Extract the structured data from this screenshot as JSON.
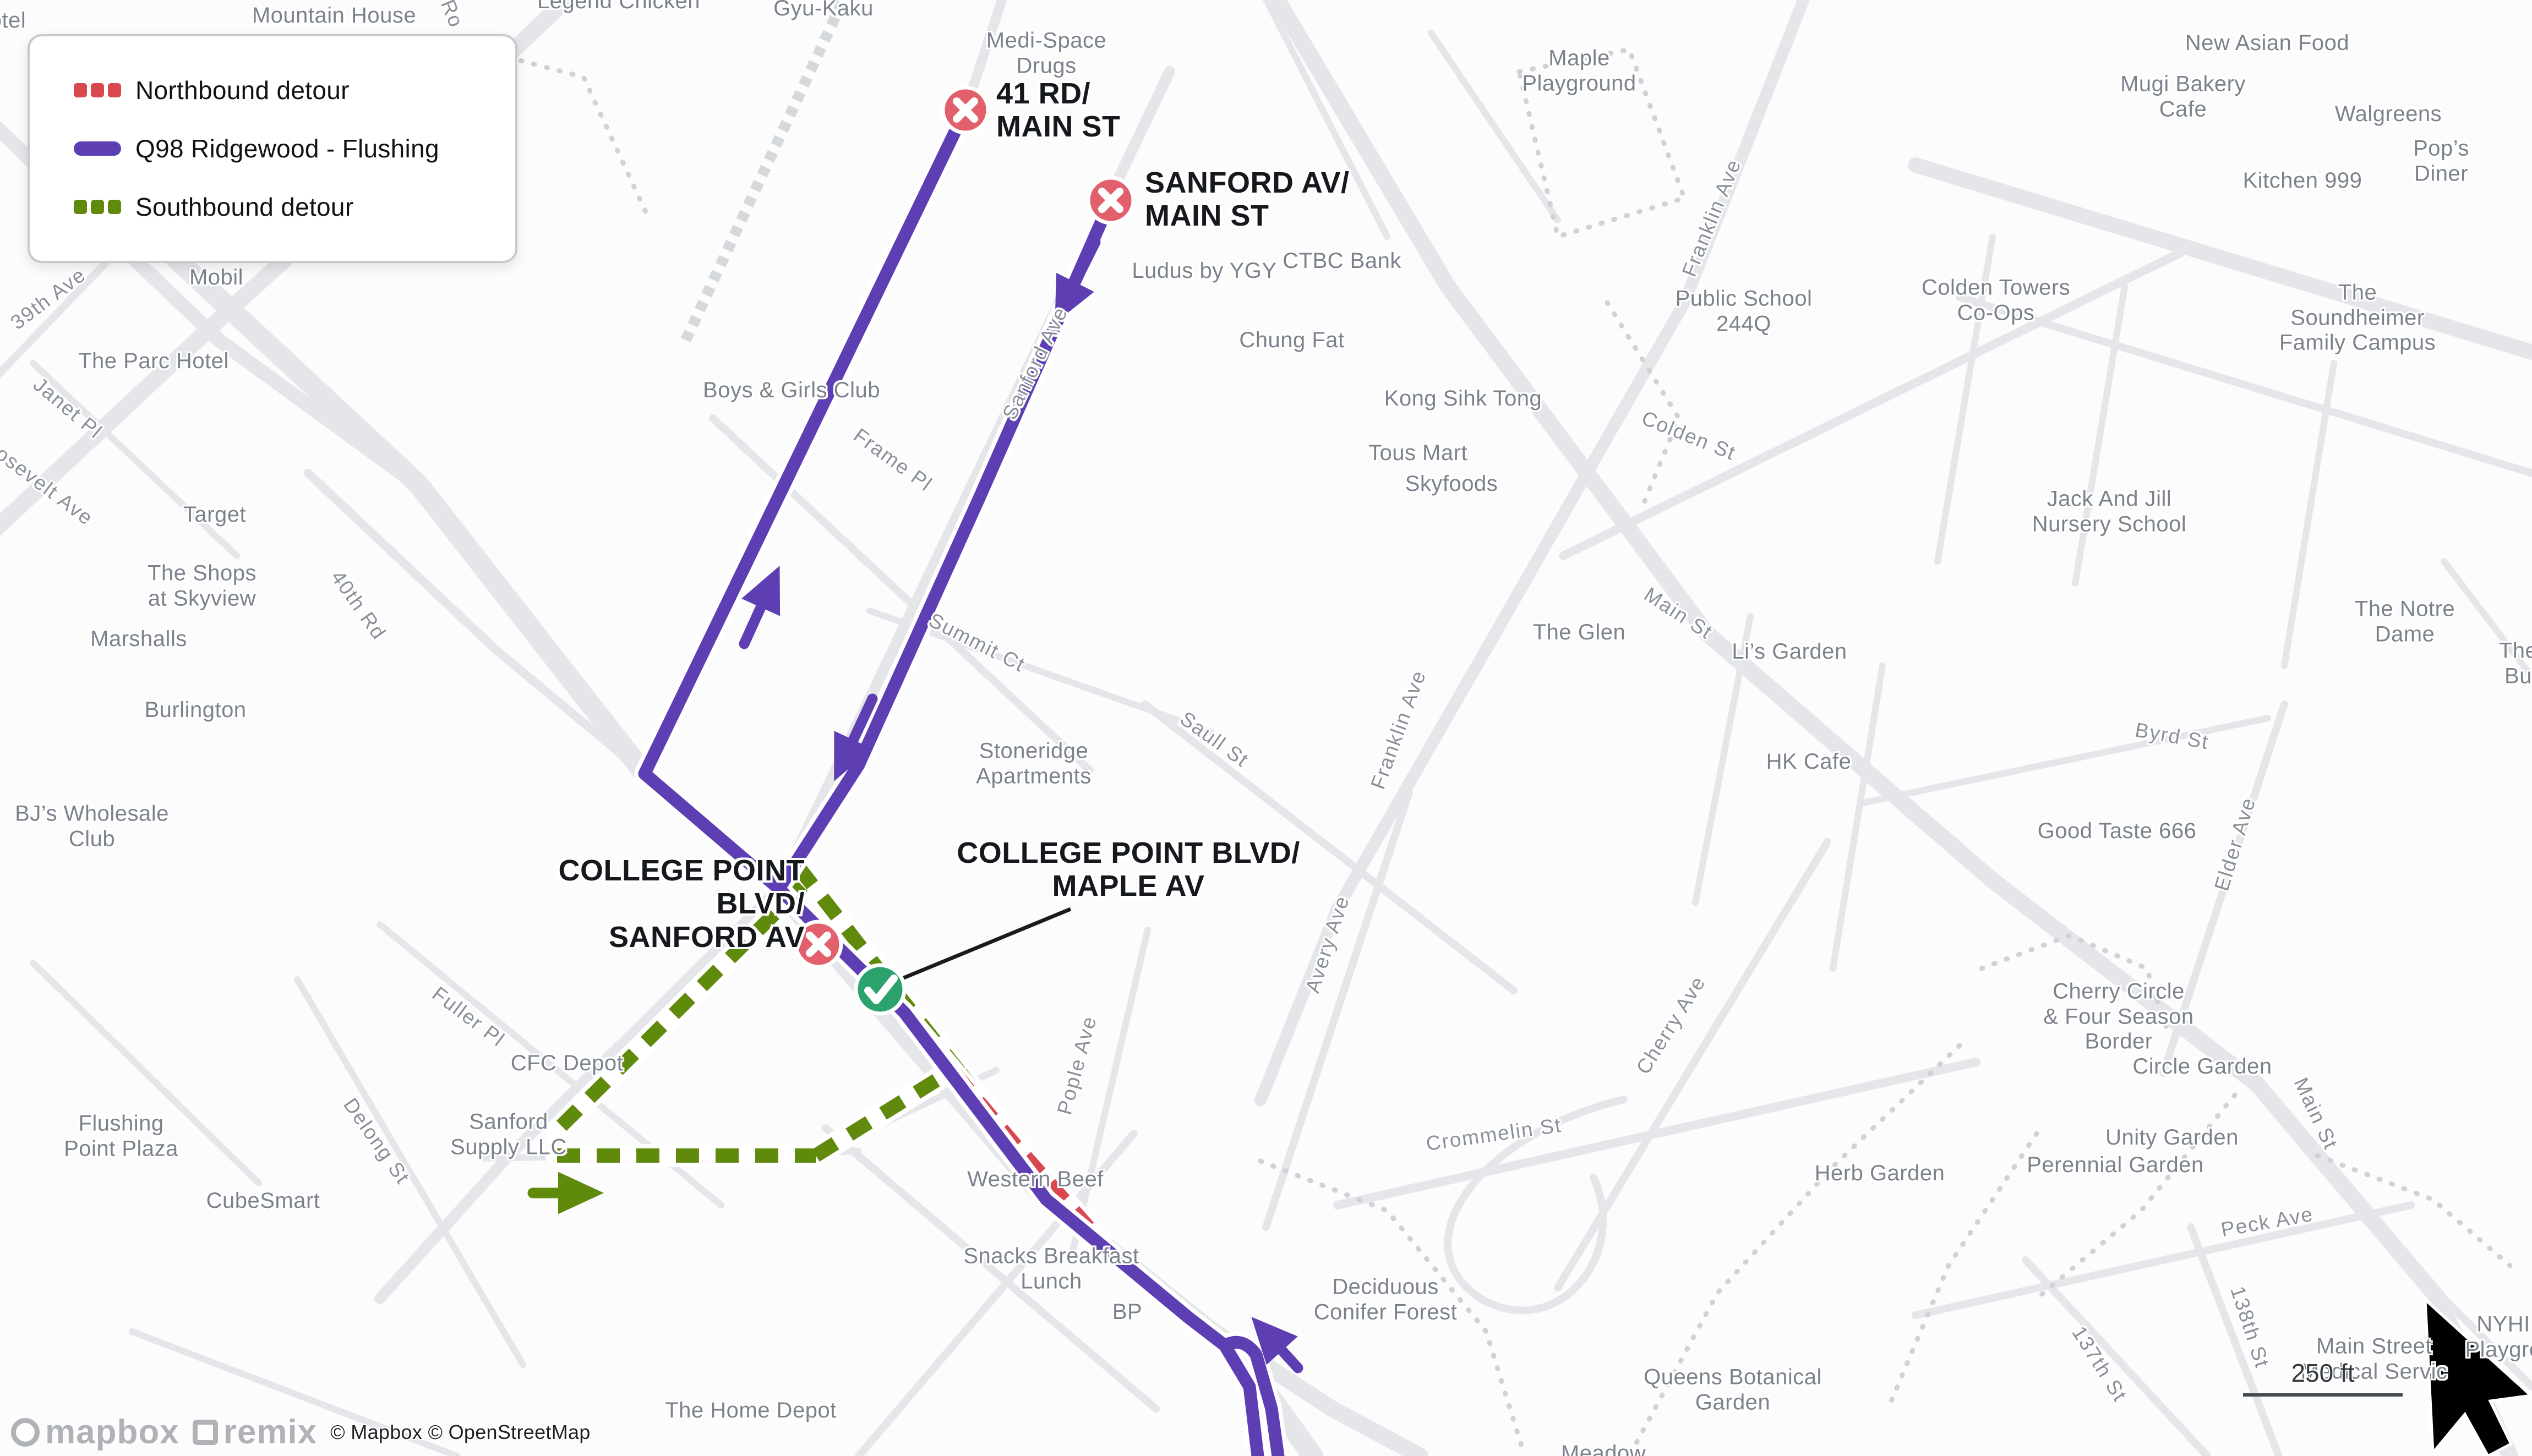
{
  "legend": {
    "items": [
      {
        "label": "Northbound detour",
        "color": "#D9474F",
        "style": "dashed"
      },
      {
        "label": "Q98 Ridgewood - Flushing",
        "color": "#5D3EB3",
        "style": "solid"
      },
      {
        "label": "Southbound detour",
        "color": "#5F8A0C",
        "style": "dashed"
      }
    ]
  },
  "stops": {
    "rd41": "41 RD/\nMAIN ST",
    "sanford": "SANFORD AV/\nMAIN ST",
    "cp_sanford": "COLLEGE POINT BLVD/\nSANFORD AV",
    "cp_maple": "COLLEGE POINT BLVD/\nMAPLE AV"
  },
  "labels": {
    "otel": "otel",
    "mountain_house": "Mountain House",
    "legend_chicken": "Legend Chicken",
    "gyu_kaku": "Gyu-Kaku",
    "medi_space": "Medi-Space\nDrugs",
    "new_asian": "New Asian Food",
    "mugi": "Mugi Bakery\nCafe",
    "walgreens": "Walgreens",
    "pops": "Pop’s Diner",
    "kitchen999": "Kitchen 999",
    "maple_pg": "Maple\nPlayground",
    "ludus": "Ludus by YGY",
    "ctbc": "CTBC Bank",
    "chung_fat": "Chung Fat",
    "colden_towers": "Colden Towers\nCo-Ops",
    "soundheimer": "The Soundheimer\nFamily Campus",
    "ps244": "Public School\n244Q",
    "kong": "Kong Sihk Tong",
    "tous": "Tous Mart",
    "skyfoods": "Skyfoods",
    "jackjill": "Jack And Jill\nNursery School",
    "mobil": "Mobil",
    "parc": "The Parc Hotel",
    "target": "Target",
    "shops_skyview": "The Shops\nat Skyview",
    "marshalls": "Marshalls",
    "burlington": "Burlington",
    "boys_girls": "Boys & Girls Club",
    "stoneridge": "Stoneridge\nApartments",
    "glen": "The Glen",
    "lis_garden": "Li’s Garden",
    "hk_cafe": "HK Cafe",
    "good_taste": "Good Taste 666",
    "notre_dame": "The Notre Dame",
    "the_bu": "The Bu",
    "cfc": "CFC Depot",
    "sanford_supply": "Sanford\nSupply LLC",
    "flushing_pp": "Flushing\nPoint Plaza",
    "cubesmart": "CubeSmart",
    "bjs": "BJ’s Wholesale\nClub",
    "western_beef": "Western Beef",
    "herb": "Herb Garden",
    "perennial": "Perennial Garden",
    "unity": "Unity Garden",
    "circle_g": "Circle Garden",
    "cherry_circle": "Cherry Circle\n& Four Season\nBorder",
    "ms_medical": "Main Street\nMedical Servic",
    "nyh": "NYHI\nPlaygro",
    "qbg": "Queens Botanical\nGarden",
    "meadow": "Meadow",
    "deciduous": "Deciduous\nConifer Forest",
    "snacks": "Snacks Breakfast\nLunch",
    "bp": "BP",
    "home_depot": "The Home Depot",
    "ro": "Ro",
    "franklin_n": "Franklin Ave",
    "colden_st": "Colden St",
    "s39": "39th Ave",
    "janet": "Janet Pl",
    "roosevelt": "Roosevelt Ave",
    "r40th": "40th Rd",
    "frame": "Frame Pl",
    "sanford_ave": "Sanford Ave",
    "summit": "Summit Ct",
    "main_c": "Main St",
    "saull": "Saull St",
    "franklin_m": "Franklin Ave",
    "byrd": "Byrd St",
    "elder": "Elder Ave",
    "fuller": "Fuller Pl",
    "delong": "Delong St",
    "pople": "Pople Ave",
    "avery": "Avery Ave",
    "crommelin": "Crommelin St",
    "cherry_ave": "Cherry Ave",
    "peck": "Peck Ave",
    "main_r": "Main St",
    "s138": "138th St",
    "s137": "137th St"
  },
  "scalebar": {
    "label": "250 ft"
  },
  "attribution": {
    "logo_mapbox": "mapbox",
    "logo_remix": "remix",
    "copyright": "© Mapbox © OpenStreetMap"
  },
  "colors": {
    "route_purple": "#5D3EB3",
    "detour_red": "#D9474F",
    "detour_green": "#5F8A0C",
    "closed_marker": "#E2606B",
    "open_marker": "#2CA36F",
    "road_gray": "#E4E6E9"
  }
}
